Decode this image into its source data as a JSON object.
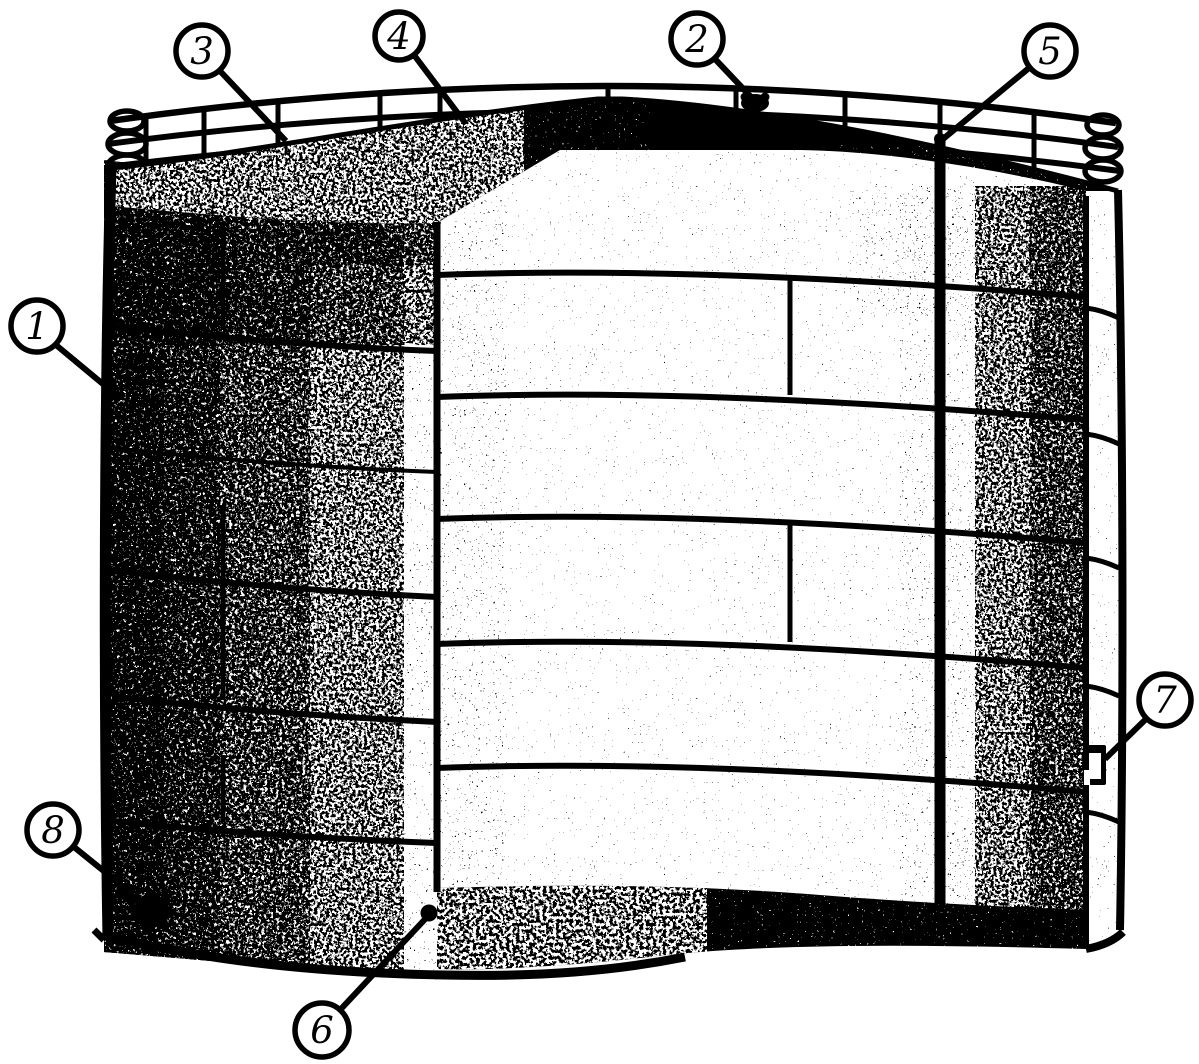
{
  "figure": {
    "paper_color": "#ffffff",
    "ink_color": "#000000"
  },
  "callouts": [
    {
      "number": "1"
    },
    {
      "number": "2"
    },
    {
      "number": "3"
    },
    {
      "number": "4"
    },
    {
      "number": "5"
    },
    {
      "number": "6"
    },
    {
      "number": "7"
    },
    {
      "number": "8"
    }
  ]
}
